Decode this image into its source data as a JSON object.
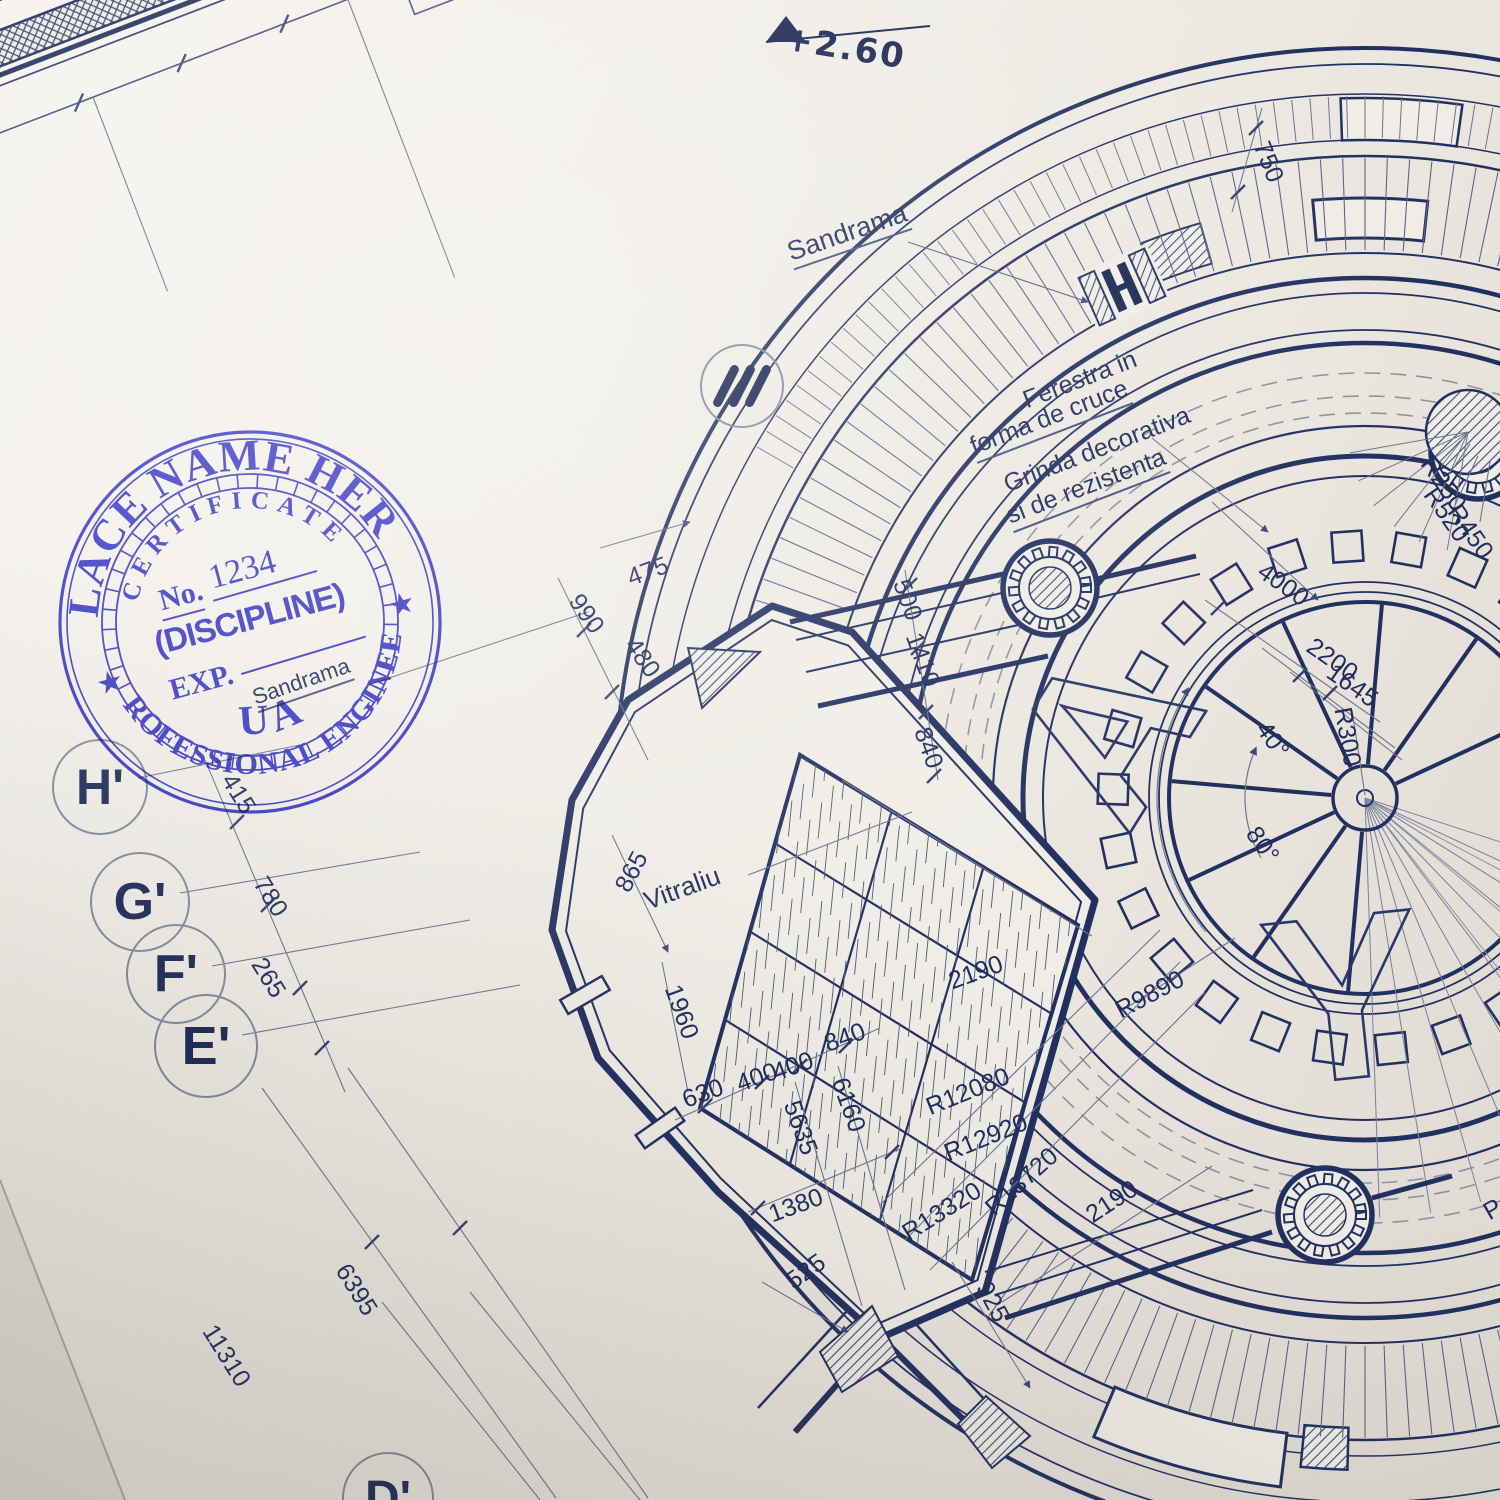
{
  "scene": {
    "description": "Photographed architectural blueprint of a circular amphitheater plan with a blue round Professional Engineer stamp",
    "colors": {
      "paper": "#f0ede7",
      "ink": "#223060",
      "thin_line": "#6d7590",
      "stamp_ink": "#2d2dd2"
    }
  },
  "stamp": {
    "outer_top": "PLACE NAME HERE",
    "outer_bottom": "PROFESSIONAL ENGINEER",
    "inner_top": "CERTIFICATE",
    "inner_bottom": "GUAM",
    "no_label": "No.",
    "no_value": "1234",
    "discipline": "(DISCIPLINE)",
    "exp_label": "EXP.",
    "star_left": "★",
    "star_right": "★"
  },
  "level_marker": {
    "text": "+2.60"
  },
  "annotations": [
    {
      "t": "+2.60",
      "x": 845,
      "y": 48,
      "r": 9,
      "s": 34,
      "cls": "hand"
    },
    {
      "t": "Sandrama",
      "x": 848,
      "y": 235,
      "r": -19,
      "s": 27,
      "u": true
    },
    {
      "t": "Ferestra in",
      "x": 1080,
      "y": 380,
      "r": -21,
      "s": 25
    },
    {
      "t": "forma de cruce",
      "x": 1050,
      "y": 420,
      "r": -21,
      "s": 25,
      "u": true
    },
    {
      "t": "Grinda decorativa",
      "x": 1097,
      "y": 450,
      "r": -21,
      "s": 25
    },
    {
      "t": "si de rezistenta",
      "x": 1087,
      "y": 489,
      "r": -21,
      "s": 25,
      "u": true
    },
    {
      "t": "Sandrama",
      "x": 302,
      "y": 684,
      "r": -19,
      "s": 22,
      "u": true
    },
    {
      "t": "Vitraliu",
      "x": 682,
      "y": 888,
      "r": -20,
      "s": 26
    }
  ],
  "dimensions": [
    {
      "t": "750",
      "x": 1268,
      "y": 162,
      "r": 68
    },
    {
      "t": "475",
      "x": 648,
      "y": 572,
      "r": -20
    },
    {
      "t": "990",
      "x": 586,
      "y": 614,
      "r": 55
    },
    {
      "t": "480",
      "x": 642,
      "y": 658,
      "r": 55
    },
    {
      "t": "500",
      "x": 907,
      "y": 600,
      "r": 70
    },
    {
      "t": "1410",
      "x": 922,
      "y": 660,
      "r": 70
    },
    {
      "t": "840",
      "x": 928,
      "y": 748,
      "r": 70
    },
    {
      "t": "4000",
      "x": 1283,
      "y": 585,
      "r": 35
    },
    {
      "t": "2200",
      "x": 1332,
      "y": 660,
      "r": 35
    },
    {
      "t": "1645",
      "x": 1352,
      "y": 686,
      "r": 35
    },
    {
      "t": "R300",
      "x": 1347,
      "y": 737,
      "r": 80
    },
    {
      "t": "40°",
      "x": 1272,
      "y": 740,
      "r": 55
    },
    {
      "t": "80°",
      "x": 1262,
      "y": 845,
      "r": 55
    },
    {
      "t": "R250",
      "x": 1443,
      "y": 484,
      "r": 55
    },
    {
      "t": "R520",
      "x": 1446,
      "y": 515,
      "r": 55
    },
    {
      "t": "R450",
      "x": 1470,
      "y": 532,
      "r": 55
    },
    {
      "t": "865",
      "x": 632,
      "y": 872,
      "r": -62
    },
    {
      "t": "415",
      "x": 238,
      "y": 794,
      "r": 58
    },
    {
      "t": "780",
      "x": 270,
      "y": 897,
      "r": 58
    },
    {
      "t": "265",
      "x": 268,
      "y": 978,
      "r": 58
    },
    {
      "t": "1960",
      "x": 681,
      "y": 1012,
      "r": 70
    },
    {
      "t": "630",
      "x": 703,
      "y": 1094,
      "r": -20
    },
    {
      "t": "400",
      "x": 757,
      "y": 1078,
      "r": -20
    },
    {
      "t": "400",
      "x": 793,
      "y": 1067,
      "r": -20
    },
    {
      "t": "840",
      "x": 845,
      "y": 1038,
      "r": -20
    },
    {
      "t": "6160",
      "x": 848,
      "y": 1105,
      "r": 70
    },
    {
      "t": "5635",
      "x": 800,
      "y": 1128,
      "r": 70
    },
    {
      "t": "1380",
      "x": 796,
      "y": 1206,
      "r": -20
    },
    {
      "t": "525",
      "x": 806,
      "y": 1272,
      "r": -35
    },
    {
      "t": "925",
      "x": 992,
      "y": 1302,
      "r": 62
    },
    {
      "t": "2190",
      "x": 976,
      "y": 973,
      "r": -20
    },
    {
      "t": "2190",
      "x": 1112,
      "y": 1202,
      "r": -33
    },
    {
      "t": "R9890",
      "x": 1150,
      "y": 995,
      "r": -28
    },
    {
      "t": "R12080",
      "x": 968,
      "y": 1092,
      "r": -22
    },
    {
      "t": "R12920",
      "x": 986,
      "y": 1138,
      "r": -22
    },
    {
      "t": "R13720",
      "x": 1022,
      "y": 1182,
      "r": -42
    },
    {
      "t": "R13320",
      "x": 942,
      "y": 1212,
      "r": -32
    },
    {
      "t": "6395",
      "x": 356,
      "y": 1290,
      "r": 58
    },
    {
      "t": "11310",
      "x": 226,
      "y": 1356,
      "r": 58
    },
    {
      "t": "P",
      "x": 1493,
      "y": 1210,
      "r": -30
    }
  ],
  "grid_bubbles": [
    {
      "label": "H'",
      "x": 100,
      "y": 787,
      "d": 92,
      "s": 50
    },
    {
      "label": "G'",
      "x": 140,
      "y": 902,
      "d": 96,
      "s": 52
    },
    {
      "label": "F'",
      "x": 176,
      "y": 974,
      "d": 96,
      "s": 52
    },
    {
      "label": "E'",
      "x": 206,
      "y": 1046,
      "d": 100,
      "s": 54
    },
    {
      "label": "D'",
      "x": 388,
      "y": 1498,
      "d": 88,
      "s": 48
    },
    {
      "label": "III",
      "x": 742,
      "y": 386,
      "d": 80,
      "type": "bars"
    }
  ],
  "big_letters": [
    {
      "ch": "A",
      "x": 1168,
      "y": 772,
      "rot": -58,
      "size": 215
    },
    {
      "ch": "Y",
      "x": 1352,
      "y": 1078,
      "rot": -6,
      "size": 235
    }
  ]
}
